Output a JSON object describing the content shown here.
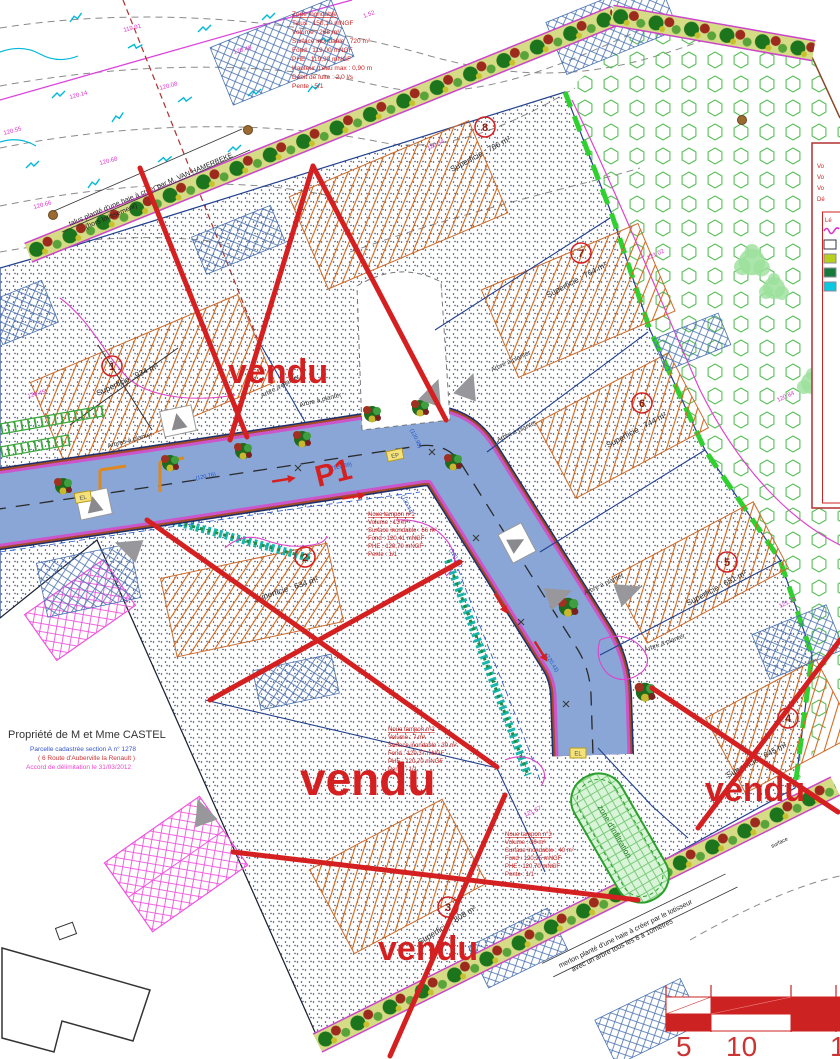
{
  "colors": {
    "stamp_red": "#d42020",
    "road_blue": "#89a6d6",
    "hedge_base": "#d6db85",
    "boundary_green": "#2fd02f",
    "hatch_orange": "#d2691e",
    "magenta": "#dd44cc",
    "navy": "#22418f",
    "note_red": "#cc2222",
    "cyan": "#00b8d8"
  },
  "flood_note": {
    "title": "Zone inondable",
    "lines": [
      "Talus : 150,10 mNGF",
      "Volume : 268 m³",
      "Surface inondable : 720 m²",
      "Fond : 119,00 mNGF",
      "PHE : 119,90 mNGF",
      "Hauteur d'eau max : 0,90 m",
      "Débit de fuite : 2,0 l/s",
      "Pente : 5/1"
    ]
  },
  "noues": [
    {
      "title": "Noue tampon n°1",
      "lines": [
        "Volume : 13 m³",
        "Surface inondable : 66 m²",
        "Fond : 120,41 mNGF",
        "PHE : 120,70 mNGF",
        "Pente : 1/1"
      ]
    },
    {
      "title": "Noue tampon n°2",
      "lines": [
        "Volume : 7 m³",
        "Surface inondable : 30 m²",
        "Fond : 120,37 mNGF",
        "PHE : 120,70 mNGF",
        "Pente : 1/1"
      ]
    },
    {
      "title": "Noue tampon n°3",
      "lines": [
        "Volume : 30 m³",
        "Surface inondable : 40 m²",
        "Fond : 120,25 mNGF",
        "PHE : 120,70 mNGF",
        "Pente : 1/1"
      ]
    }
  ],
  "lots": [
    {
      "num": "1",
      "area": "Superficie : 934 m²"
    },
    {
      "num": "2",
      "area": "Superficie : 634 m²"
    },
    {
      "num": "3",
      "area": "Superficie : 808 m²"
    },
    {
      "num": "4",
      "area": "Superficie : 645 m²"
    },
    {
      "num": "5",
      "area": "Superficie : 651 m²"
    },
    {
      "num": "6",
      "area": "Superficie : 744 m²"
    },
    {
      "num": "7",
      "area": "Superficie : 764 m²"
    },
    {
      "num": "8",
      "area": "Superficie : 766 m²"
    }
  ],
  "stamp": "vendu",
  "road_label": "P1",
  "labels": {
    "hedge_top1": "talus planté d'une haie à créer par M. VAN HAMERBEKE",
    "hedge_top2": "(hors lotissement)",
    "hedge_bottom1": "merlon planté d'une haie à créer par le lotisseur",
    "hedge_bottom2": "avec un arbre tous les 8 à 10mètres",
    "infiltration": "zone d'infiltration",
    "arbre": "Arbre à planter",
    "arbres": "Arbres à planter",
    "surface": "surface"
  },
  "castel": {
    "owner": "Propriété de M et Mme CASTEL",
    "parcel": "Parcelle cadastrée section A n° 1278",
    "address": "( 6 Route d'Auberville la Renault )",
    "note": "Accord de délimitation le 31/03/2012"
  },
  "elevations": [
    "119.91",
    "120.48",
    "120.08",
    "120.14",
    "120.55",
    "120.68",
    "120.66",
    "120.34",
    "121.02",
    "120.84",
    "121.18",
    "120.45",
    "1.52",
    "121.67"
  ],
  "cotes": [
    "(120.89)",
    "(120.98)",
    "(120.44)",
    "(120.76)",
    "(120.43)",
    "(120.88)"
  ],
  "panel": {
    "lines": [
      "Vo",
      "Vo",
      "Vo",
      "Dé"
    ],
    "legend_title": "Lé"
  },
  "scale_numbers": [
    "5",
    "10",
    "1"
  ],
  "utility_boxes": [
    "EL",
    "EP",
    "EL"
  ]
}
